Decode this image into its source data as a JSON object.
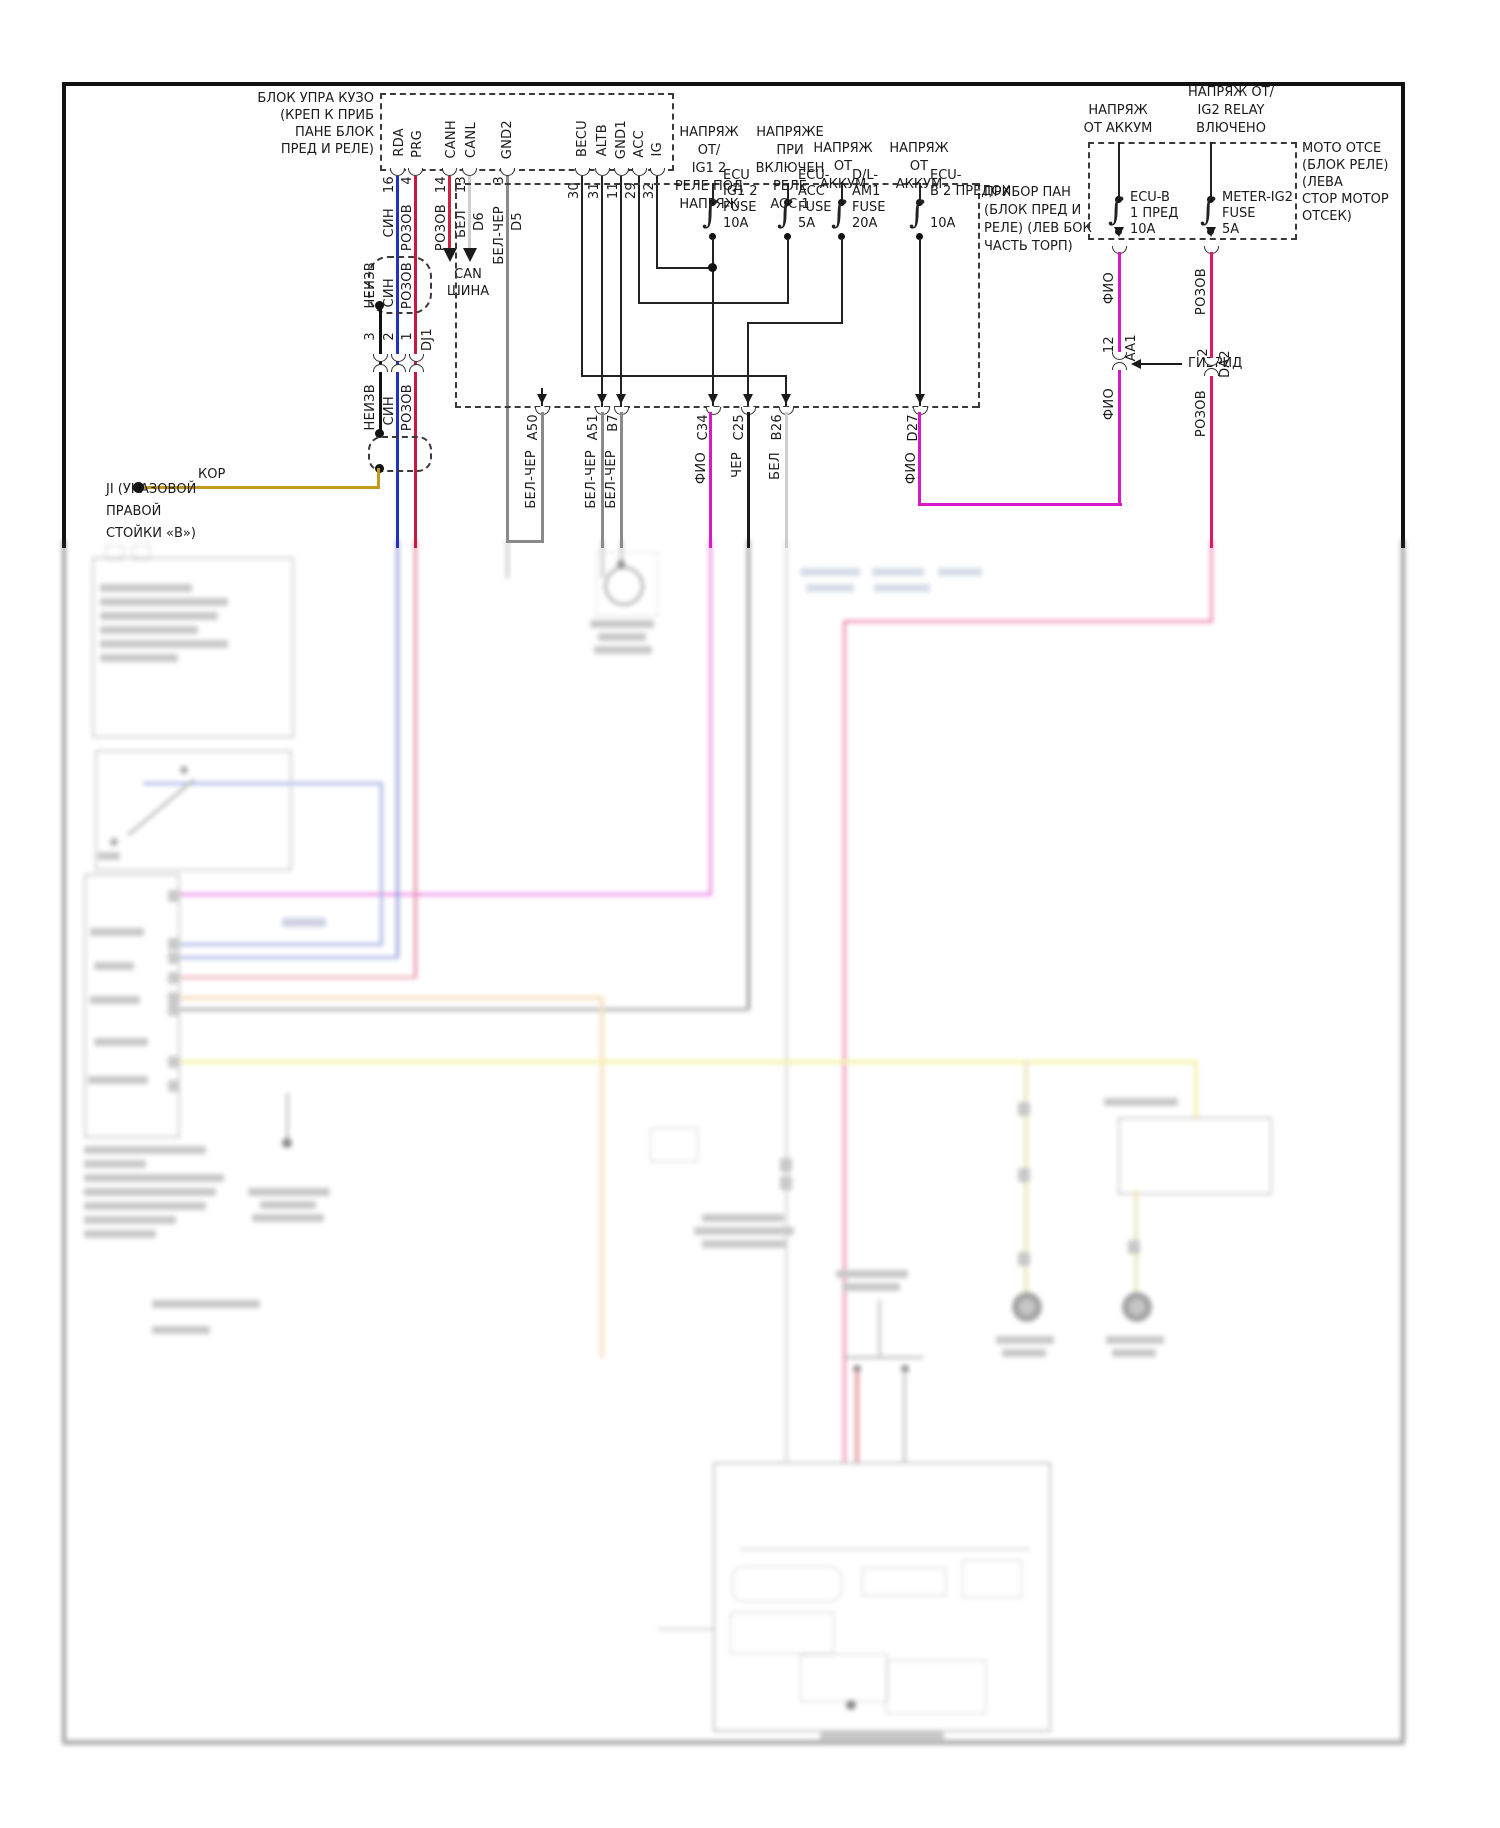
{
  "title": "Схема электрооборудования (приборная панель / гибрид)",
  "colors": {
    "blue": "#2233bb",
    "crimson": "#c81840",
    "red_can": "#cc2244",
    "magenta": "#d819c8",
    "pink": "#e0186a",
    "gray": "#8a8a8a",
    "white_wire": "#cfcfcf",
    "black": "#1a1a1a",
    "kor_yellow": "#c09a18",
    "tan": "#f0c080",
    "yellow": "#e8e358",
    "olive": "#d8d27a"
  },
  "icons": {
    "fuse": "∫"
  },
  "body_ecu": {
    "label": "БЛОК УПРА КУЗО\n(КРЕП К ПРИБ\nПАНЕ БЛОК\nПРЕД И РЕЛЕ)",
    "pins": [
      {
        "n": "RDA",
        "num": "16"
      },
      {
        "n": "PRG",
        "num": "4"
      },
      {
        "n": "CANH",
        "num": "14"
      },
      {
        "n": "CANL",
        "num": "13"
      },
      {
        "n": "GND2",
        "num": "3"
      },
      {
        "n": "BECU",
        "num": "30"
      },
      {
        "n": "ALTB",
        "num": "31"
      },
      {
        "n": "GND1",
        "num": "11"
      },
      {
        "n": "ACC",
        "num": "29"
      },
      {
        "n": "IG",
        "num": "32"
      }
    ],
    "d6": "D6",
    "d5": "D5"
  },
  "top_wires": {
    "sin": "СИН",
    "rozov1": "РОЗОВ",
    "rozov2": "РОЗОВ",
    "bel": "БЕЛ",
    "belcher": "БЕЛ-ЧЕР"
  },
  "can": "CAN\nШИНА",
  "left_conn": {
    "neizv": "НЕИЗВ",
    "n3": "3",
    "sin": "СИН",
    "n2": "2",
    "rozov": "РОЗОВ",
    "n1": "1",
    "dj1": "DJ1",
    "low_neizv": "НЕИЗВ",
    "low_sin": "СИН",
    "low_rozov": "РОЗОВ"
  },
  "kor": {
    "wire": "КОР",
    "label": "JI (УКАЗОВОЙ\nПРАВОЙ\nСТОЙКИ «В»)"
  },
  "pp": {
    "label": "ПРИБОР ПАН\n(БЛОК ПРЕД И\nРЕЛЕ) (ЛЕВ БОК\nЧАСТЬ ТОРП)",
    "h1": "НАПРЯЖ ОТ/\nIG1 2\nРЕЛЕ ПОД\nНАПРЯЖ",
    "h2": "НАПРЯЖЕ\nПРИ ВКЛЮЧЕН\nРЕЛЕ\nACC 1",
    "h3": "НАПРЯЖ\nОТ\nАККУМ",
    "h4": "НАПРЯЖ\nОТ\nАККУМ",
    "f1": "ECU\nIG1 2\nFUSE\n10A",
    "f2": "ECU-\nACC\nFUSE\n5A",
    "f3": "D/L-\nAM1\nFUSE\n20A",
    "f4": "ECU-\nВ 2 ПРЕДОХ\n\n10A",
    "conns": [
      {
        "id": "A50",
        "c": "БЕЛ-ЧЕР"
      },
      {
        "id": "A51",
        "c": "БЕЛ-ЧЕР"
      },
      {
        "id": "B7",
        "c": "БЕЛ-ЧЕР"
      },
      {
        "id": "C34",
        "c": "ФИО"
      },
      {
        "id": "C25",
        "c": "ЧЕР"
      },
      {
        "id": "B26",
        "c": "БЕЛ"
      },
      {
        "id": "D27",
        "c": "ФИО"
      }
    ]
  },
  "rb": {
    "h5": "НАПРЯЖ\nОТ АККУМ",
    "h6": "НАПРЯЖ ОТ/\nIG2 RELAY\nВЛЮЧЕНО",
    "f5": "ECU-B\n1 ПРЕД\n10A",
    "f6": "METER-IG2\nFUSE\n5A",
    "moto": "МОТО ОТСЕ\n(БЛОК РЕЛЕ)\n(ЛЕВА\nСТОР МОТОР\nОТСЕК)",
    "fio_a": "ФИО",
    "fio_b": "ФИО",
    "roz_a": "РОЗОВ",
    "roz_b": "РОЗОВ",
    "n12": "12",
    "aa1": "AA1",
    "gibrid": "ГИБРИД",
    "n2": "2",
    "da2": "DA2"
  }
}
